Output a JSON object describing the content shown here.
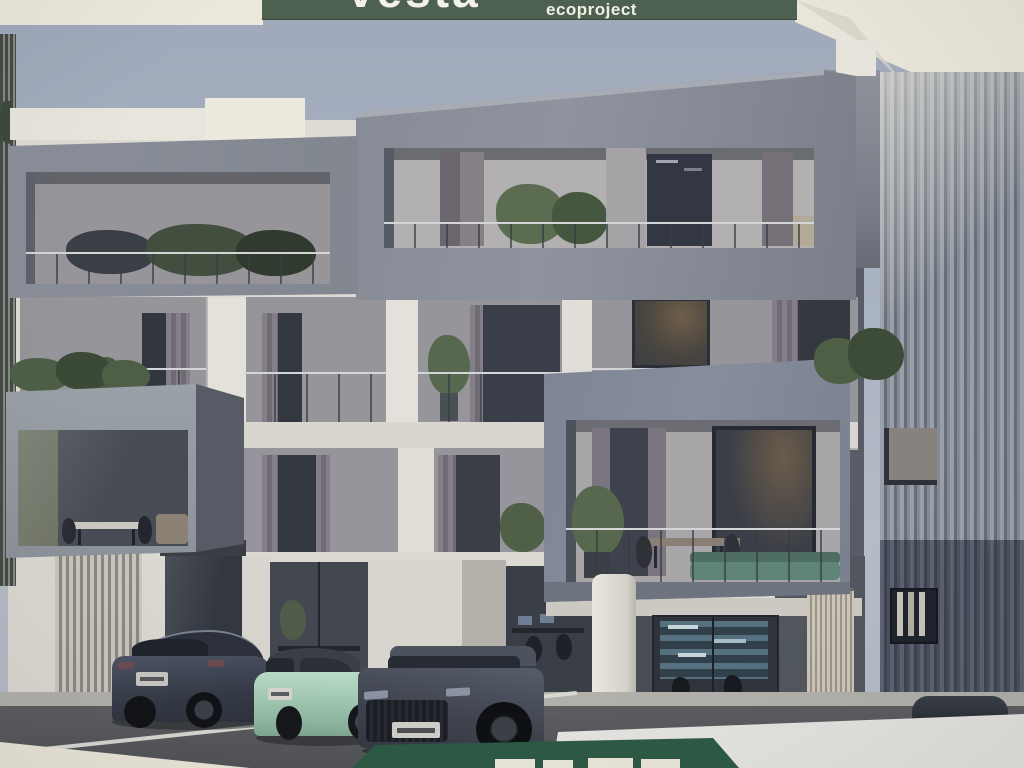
{
  "photo": {
    "description": "Photograph of an architectural rendering poster: modern white residential building with protruding gray balcony boxes, vertical-louver side tower, ground-floor glass offices and three parked cars",
    "margin_color": "#ece8db"
  },
  "header_banner": {
    "brand": "vesta",
    "subtitle": "ecoproject",
    "bg": "#4e6150",
    "text_color": "#f2f2e8"
  },
  "footer_banner": {
    "bg": "#2d5945",
    "note": "dark green trapezoid with tops of white lettering cropped at bottom edge"
  },
  "palette": {
    "sky": "#a9b2c1",
    "facade_white": "#dedbd4",
    "box_gray": "#8a8f99",
    "box_blue_gray": "#7d8594",
    "louver_light": "#9aa0aa",
    "louver_dark": "#4e5460",
    "window_glass": "#3a3e47",
    "road": "#55575b",
    "plant_green": "#52634a",
    "shelf_blue": "#55707f"
  },
  "cars": [
    {
      "label": "dark blue-gray SUV coupe, rear view",
      "color": "#454b59"
    },
    {
      "label": "mint green compact hatchback with black soft top",
      "color": "#a9d3bd"
    },
    {
      "label": "dark gray SUV, front view",
      "color": "#4e545f"
    },
    {
      "label": "dark car roof behind low white wall",
      "color": "#2a2e35"
    }
  ]
}
